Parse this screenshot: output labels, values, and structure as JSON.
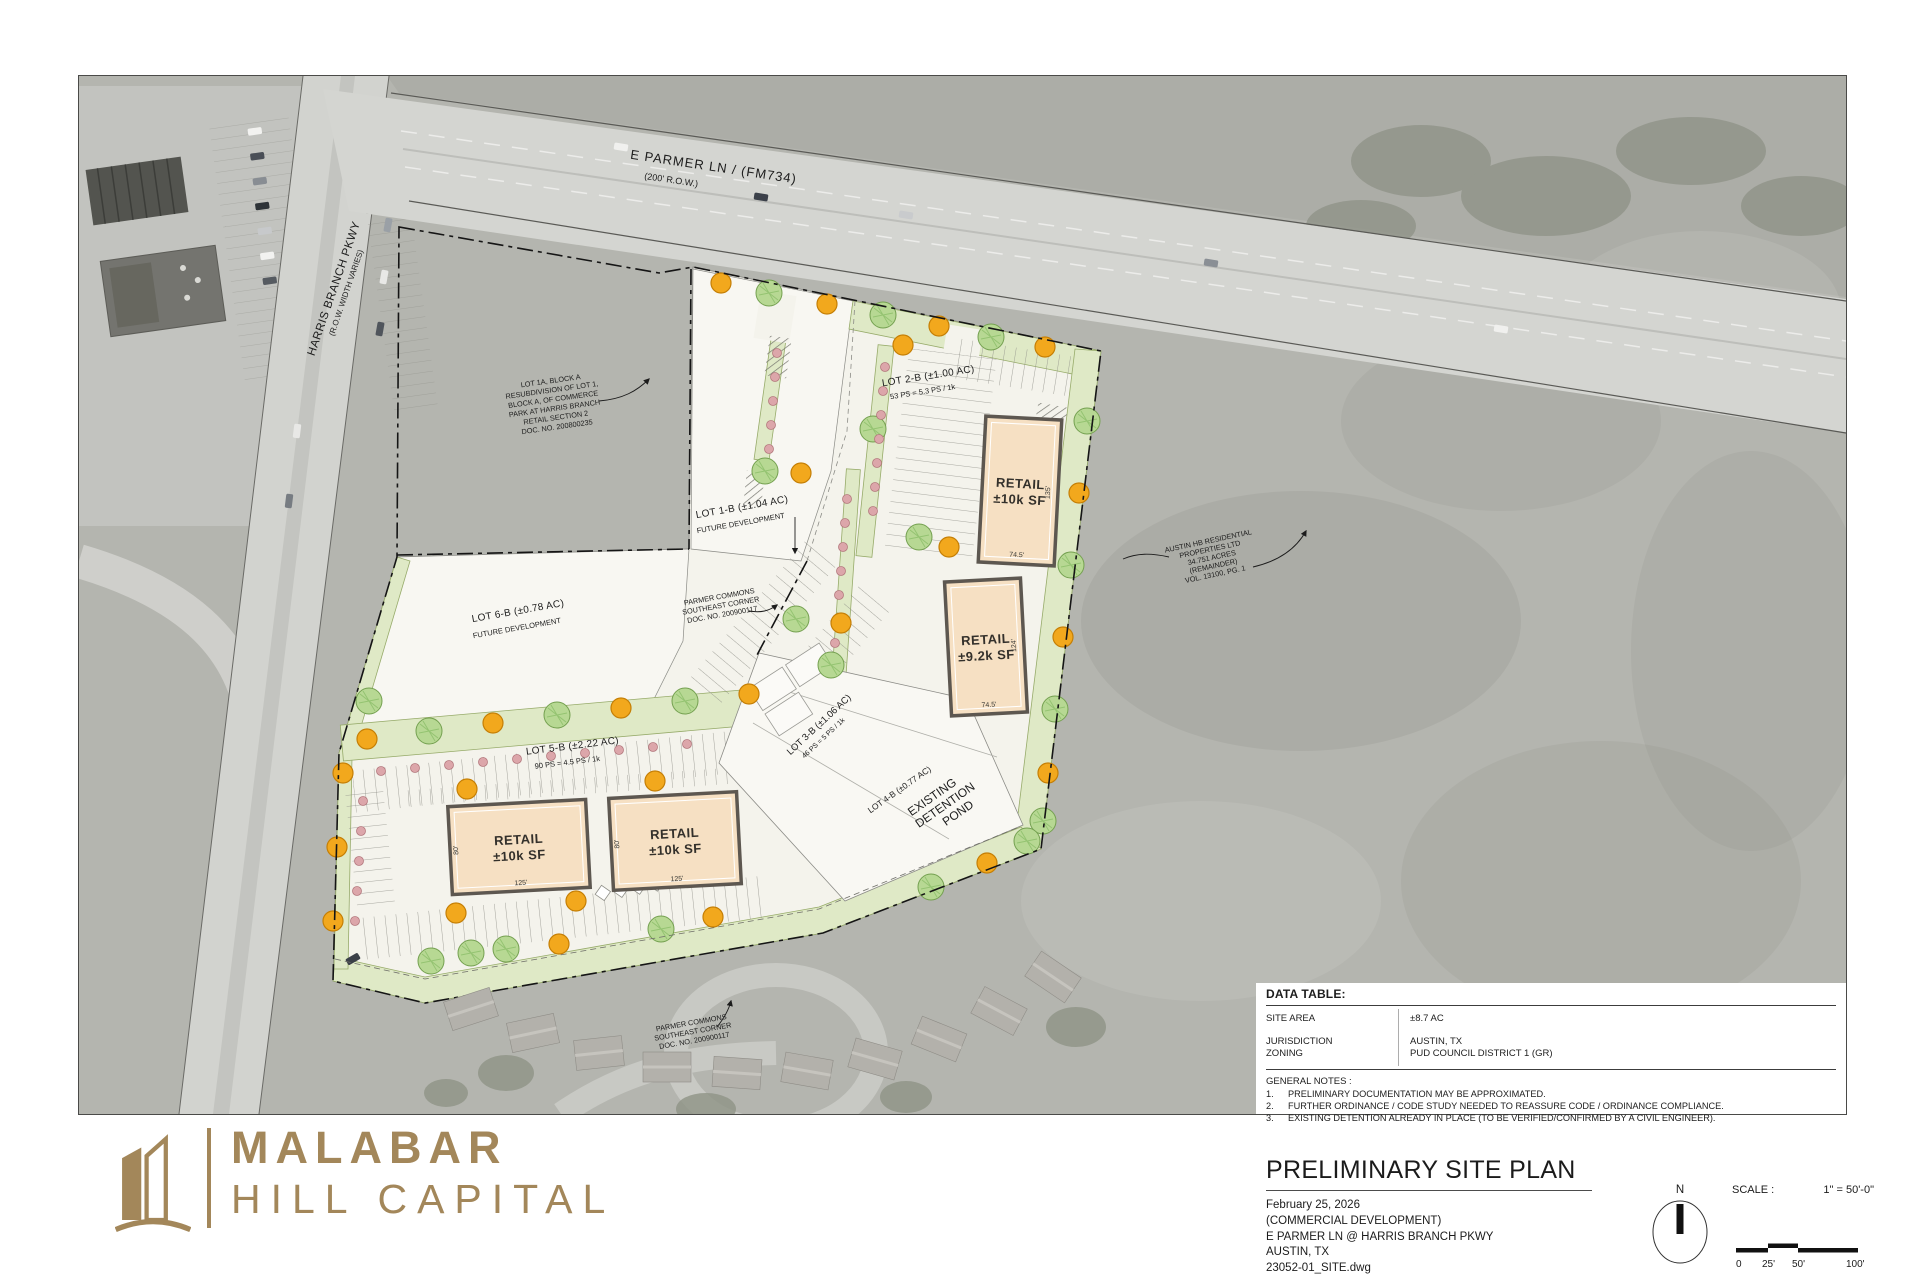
{
  "map": {
    "roads": {
      "parmer_name": "E PARMER LN / (FM734)",
      "parmer_row": "(200' R.O.W.)",
      "harris_name": "HARRIS BRANCH PKWY",
      "harris_row": "(R.O.W. WIDTH VARIES)"
    },
    "annotations": {
      "lot1a": [
        "LOT 1A, BLOCK A",
        "RESUBDIVISION OF LOT 1,",
        "BLOCK A, OF COMMERCE",
        "PARK AT HARRIS BRANCH",
        "RETAIL SECTION 2",
        "DOC. NO. 200800235"
      ],
      "pc_west": [
        "PARMER COMMONS",
        "SOUTHEAST CORNER",
        "DOC. NO. 200900117"
      ],
      "pc_south": [
        "PARMER COMMONS",
        "SOUTHEAST CORNER",
        "DOC. NO. 200900117"
      ],
      "austin_hb": [
        "AUSTIN HB RESIDENTIAL",
        "PROPERTIES LTD",
        "34.751 ACRES",
        "(REMAINDER)",
        "VOL. 13100, PG. 1"
      ]
    },
    "lots": {
      "lot2b": {
        "line1": "LOT 2-B (±1.00 AC)",
        "line2": "53 PS = 5.3 PS / 1k"
      },
      "lot1b": {
        "line1": "LOT 1-B (±1.04 AC)",
        "line2": "FUTURE DEVELOPMENT"
      },
      "lot6b": {
        "line1": "LOT 6-B (±0.78 AC)",
        "line2": "FUTURE DEVELOPMENT"
      },
      "lot5b": {
        "line1": "LOT 5-B (±2.22 AC)",
        "line2": "90 PS = 4.5 PS / 1k"
      },
      "lot3b": {
        "line1": "LOT 3-B (±1.06 AC)",
        "line2": "46 PS = 5 PS / 1k"
      },
      "lot4b": {
        "line1": "LOT 4-B (±0.77 AC)"
      },
      "pond": [
        "EXISTING",
        "DETENTION",
        "POND"
      ]
    },
    "buildings": [
      {
        "label1": "RETAIL",
        "label2": "±10k SF",
        "dim_side": "135'",
        "dim_bottom": "74.5'"
      },
      {
        "label1": "RETAIL",
        "label2": "±9.2k SF",
        "dim_side": "124'",
        "dim_bottom": "74.5'"
      },
      {
        "label1": "RETAIL",
        "label2": "±10k SF",
        "dim_side": "80'",
        "dim_bottom": "125'"
      },
      {
        "label1": "RETAIL",
        "label2": "±10k SF",
        "dim_side": "80'",
        "dim_bottom": "125'"
      }
    ]
  },
  "data_table": {
    "title": "DATA TABLE:",
    "rows": [
      {
        "label": "SITE AREA",
        "value": "±8.7 AC"
      },
      {
        "label": "JURISDICTION",
        "value": "AUSTIN, TX"
      },
      {
        "label": "ZONING",
        "value": "PUD COUNCIL DISTRICT 1 (GR)"
      }
    ],
    "notes_title": "GENERAL NOTES :",
    "notes": [
      {
        "n": "1.",
        "text": "PRELIMINARY DOCUMENTATION MAY BE APPROXIMATED."
      },
      {
        "n": "2.",
        "text": "FURTHER ORDINANCE / CODE STUDY NEEDED TO REASSURE CODE / ORDINANCE COMPLIANCE."
      },
      {
        "n": "3.",
        "text": "EXISTING DETENTION ALREADY IN PLACE (TO BE VERIFIED/CONFIRMED BY A CIVIL ENGINEER)."
      }
    ]
  },
  "title_block": {
    "title": "PRELIMINARY SITE PLAN",
    "lines": [
      "February 25, 2026",
      "(COMMERCIAL DEVELOPMENT)",
      "E PARMER LN @ HARRIS BRANCH PKWY",
      "AUSTIN, TX",
      "23052-01_SITE.dwg"
    ],
    "north_label": "N",
    "scale_label": "SCALE :",
    "scale_value": "1\" = 50'-0\"",
    "scale_ticks": [
      "0",
      "25'",
      "50'",
      "100'"
    ]
  },
  "logo": {
    "line1": "MALABAR",
    "line2": "HILL CAPITAL",
    "color": "#A3875A"
  }
}
